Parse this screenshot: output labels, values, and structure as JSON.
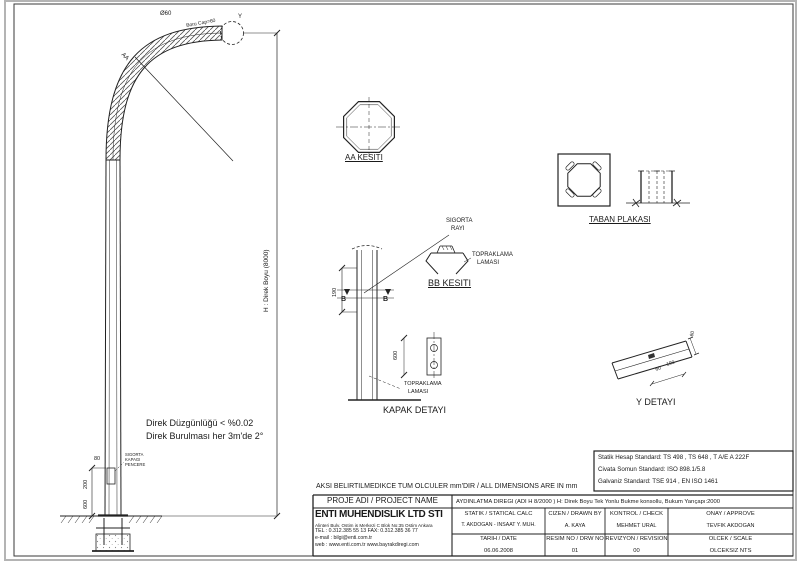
{
  "notes": {
    "units": "AKSI BELIRTILMEDIKCE TUM OLCULER mm'DIR / ALL DIMENSIONS ARE IN mm",
    "line1": "Direk Düzgünlüğü < %0.02",
    "line2": "Direk Burulması her 3m'de 2°"
  },
  "standards": {
    "l1": "Statik Hesap Standard: TS 498 , TS 648 , T A/E A 222F",
    "l2": "Civata Somun Standard: ISO 898.1/5.8",
    "l3": "Galvaniz Standard: TSE 914 , EN ISO 1461"
  },
  "pole": {
    "tip": "Ø60",
    "spigot": "Boru Cap=60",
    "y_balloon": "Y",
    "aa_cut": "AA",
    "hdim": "H : Direk Boyu (8000)",
    "d80": "80",
    "d200": "200",
    "d600": "600",
    "win": [
      "SIGORTA",
      "KAPAGI",
      "PENCERE"
    ]
  },
  "details": {
    "aa": {
      "title": "AA KESITI"
    },
    "bb": {
      "title": "BB KESITI",
      "b": "B",
      "d190": "190",
      "sig": [
        "SIGORTA",
        "RAYI"
      ],
      "top": [
        "TOPRAKLAMA",
        "LAMASI"
      ]
    },
    "kapak": {
      "title": "KAPAK DETAYI",
      "d600": "600",
      "top": [
        "TOPRAKLAMA",
        "LAMASI"
      ]
    },
    "taban": {
      "title": "TABAN PLAKASI"
    },
    "y": {
      "title": "Y DETAYI",
      "dtip": "60",
      "d60": "60",
      "d190": "190"
    }
  },
  "tb": {
    "project_label": "PROJE ADI / PROJECT NAME",
    "name": "ENTI MUHENDISLIK LTD STI",
    "address": "Alinteri Bulv. Ostim is Merkezi C Blok No:35 Ostim Ankara",
    "phone": "TEL : 0.312.385 55 13   FAX: 0.312.385 36 77",
    "email": "e-mail : bilgi@enti.com.tr",
    "web": "web : www.enti.com.tr        www.bayrakdiregi.com",
    "header": "AYDINLATMA DIREGI (ADI H 8/2000 )    H: Direk Boyu    Tek Yonlu Bukme konsollu, Bukum Yarıçapı:2000",
    "statik_l": "STATIK / STATICAL CALC",
    "statik_v": "T. AKDOGAN - INSAAT Y. MUH.",
    "cizen_l": "CIZEN / DRAWN BY",
    "cizen_v": "A. KAYA",
    "kontrol_l": "KONTROL / CHECK",
    "kontrol_v": "MEHMET URAL",
    "onay_l": "ONAY / APPROVE",
    "onay_v": "TEVFIK AKDOGAN",
    "tarih_l": "TARIH / DATE",
    "tarih_v": "06.06.2008",
    "resim_l": "RESIM NO / DRW NO",
    "resim_v": "01",
    "rev_l": "REVIZYON / REVISION",
    "rev_v": "00",
    "olcek_l": "OLCEK / SCALE",
    "olcek_v": "OLCEKSIZ  NTS"
  }
}
